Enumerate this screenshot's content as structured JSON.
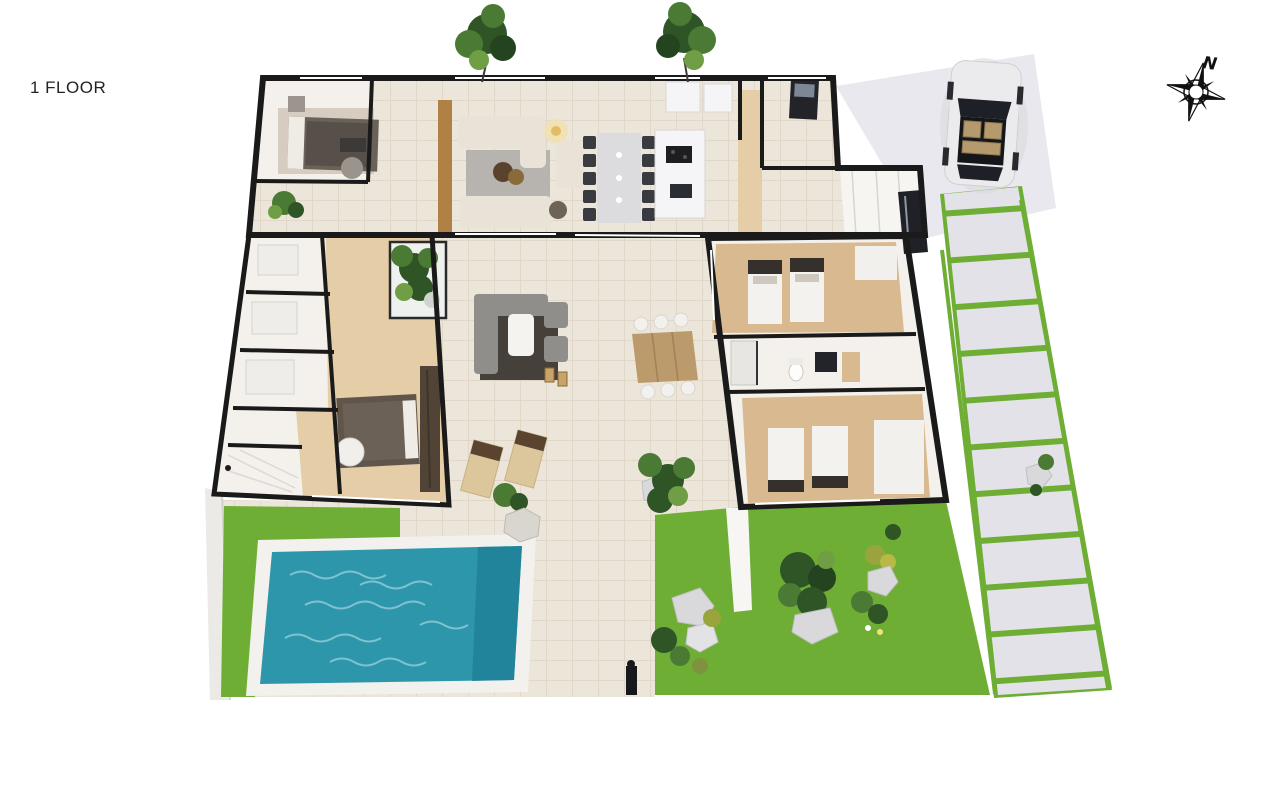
{
  "page": {
    "floor_label": "1 FLOOR"
  },
  "compass": {
    "north_label": "N"
  },
  "colors": {
    "wall": "#1a1a1a",
    "grass": "#6fae35",
    "grass_dark": "#5e9a2c",
    "pool_water": "#2e96ab",
    "pool_deep": "#1f7e95",
    "tile": "#ece5d9",
    "ground": "#e9e8ee",
    "slab": "#e3e2e8",
    "wood": "#d9ba90",
    "wood_light": "#e4cda7",
    "room_white": "#f4f1ec",
    "cream": "#e9e3d7",
    "rug_gray": "#b7b3ae",
    "dark_furniture": "#3a3b40",
    "tree_dark": "#2f5526",
    "tree_mid": "#4a7a33",
    "tree_light": "#6f9e45",
    "rock": "#d9d9dc",
    "car_body": "#ebebee",
    "glass": "#1d2026",
    "tan": "#c8a36a",
    "paper": "#ffffff",
    "text": "#222222"
  }
}
